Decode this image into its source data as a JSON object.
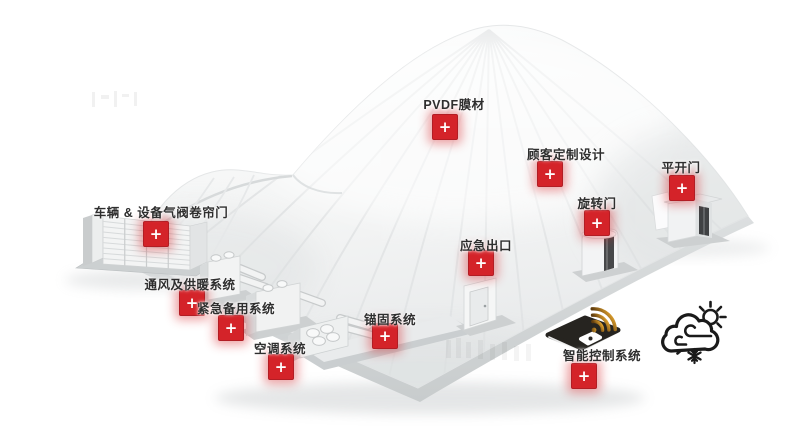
{
  "canvas": {
    "width": 800,
    "height": 426,
    "background": "#ffffff"
  },
  "colors": {
    "marker_red": "#d42329",
    "marker_border": "#b21d24",
    "marker_glow": "rgba(214,35,41,0.42)",
    "label_text": "#2e2e2e",
    "dome_light": "#fbfcfc",
    "dome_shade": "#e9ebec",
    "rib_line": "#e2e4e5",
    "base_gray": "#d3d6d7",
    "icon_black": "#1a1a1a",
    "wifi_gold_dark": "#5f3c0e",
    "wifi_gold_light": "#e2a32e"
  },
  "marker_symbol": "+",
  "hotspots": [
    {
      "id": "pvdf-membrane",
      "label": "PVDF膜材",
      "marker_x": 444,
      "marker_y": 126,
      "label_x": 454,
      "label_y": 94
    },
    {
      "id": "custom-design",
      "label": "顾客定制设计",
      "marker_x": 549,
      "marker_y": 173,
      "label_x": 566,
      "label_y": 144
    },
    {
      "id": "swing-door",
      "label": "平开门",
      "marker_x": 681,
      "marker_y": 187,
      "label_x": 681,
      "label_y": 157
    },
    {
      "id": "revolving-door",
      "label": "旋转门",
      "marker_x": 596,
      "marker_y": 222,
      "label_x": 597,
      "label_y": 193
    },
    {
      "id": "emergency-exit",
      "label": "应急出口",
      "marker_x": 480,
      "marker_y": 262,
      "label_x": 486,
      "label_y": 235
    },
    {
      "id": "vehicle-rolling-door",
      "label": "车辆 & 设备气阀卷帘门",
      "marker_x": 155,
      "marker_y": 233,
      "label_x": 161,
      "label_y": 202
    },
    {
      "id": "ventilation-heating",
      "label": "通风及供暖系统",
      "marker_x": 191,
      "marker_y": 302,
      "label_x": 190,
      "label_y": 274
    },
    {
      "id": "emergency-backup",
      "label": "紧急备用系统",
      "marker_x": 230,
      "marker_y": 327,
      "label_x": 236,
      "label_y": 298
    },
    {
      "id": "ac-system",
      "label": "空调系统",
      "marker_x": 280,
      "marker_y": 366,
      "label_x": 280,
      "label_y": 338
    },
    {
      "id": "anchor-system",
      "label": "锚固系统",
      "marker_x": 384,
      "marker_y": 335,
      "label_x": 390,
      "label_y": 309
    },
    {
      "id": "smart-control",
      "label": "智能控制系统",
      "marker_x": 583,
      "marker_y": 375,
      "label_x": 602,
      "label_y": 345
    }
  ],
  "icons": [
    {
      "name": "smart-control-tablet-wifi-icon"
    },
    {
      "name": "weather-cloud-sun-wind-snow-icon"
    }
  ]
}
